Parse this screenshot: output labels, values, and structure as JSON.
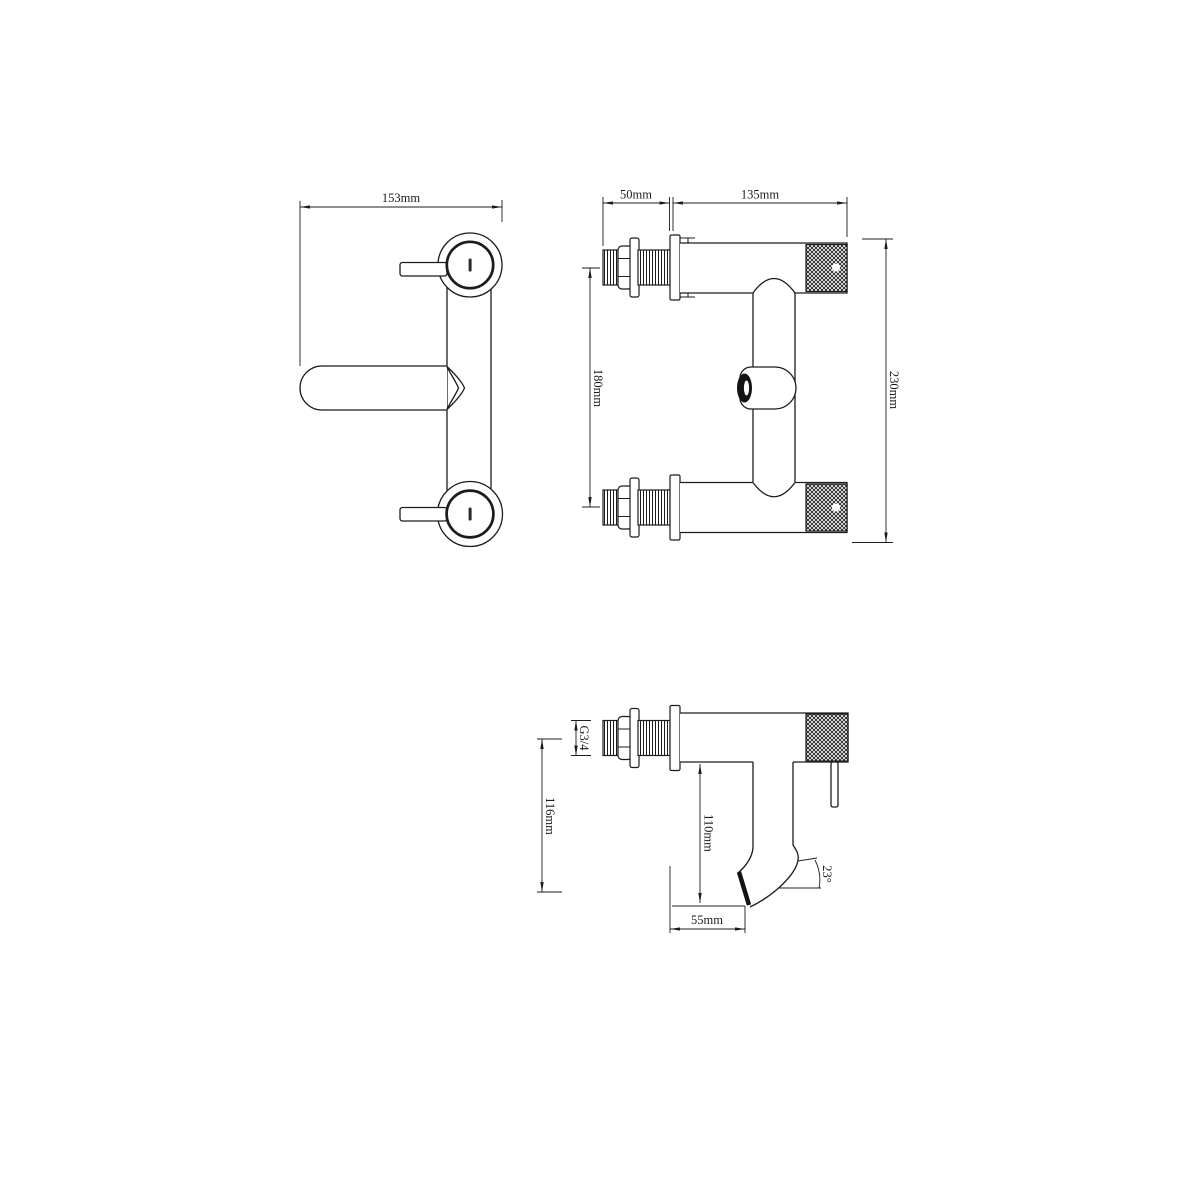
{
  "page": {
    "background": "#ffffff",
    "ink": "#1c1c1c"
  },
  "views": {
    "front": {
      "title": "front view",
      "dims": {
        "width": {
          "label": "153mm"
        }
      }
    },
    "side": {
      "title": "side view",
      "dims": {
        "stem_length": {
          "label": "50mm"
        },
        "body_length": {
          "label": "135mm"
        },
        "body_diameter": {
          "label": "Φ 50mm"
        },
        "inlet_spacing": {
          "label": "180mm"
        },
        "overall_height": {
          "label": "230mm"
        }
      }
    },
    "spout": {
      "title": "spout detail view",
      "dims": {
        "thread": {
          "label": "G3/4"
        },
        "total_drop": {
          "label": "116mm"
        },
        "spout_drop": {
          "label": "110mm"
        },
        "spout_reach": {
          "label": "55mm"
        },
        "spout_angle": {
          "label": "23°"
        }
      }
    }
  }
}
